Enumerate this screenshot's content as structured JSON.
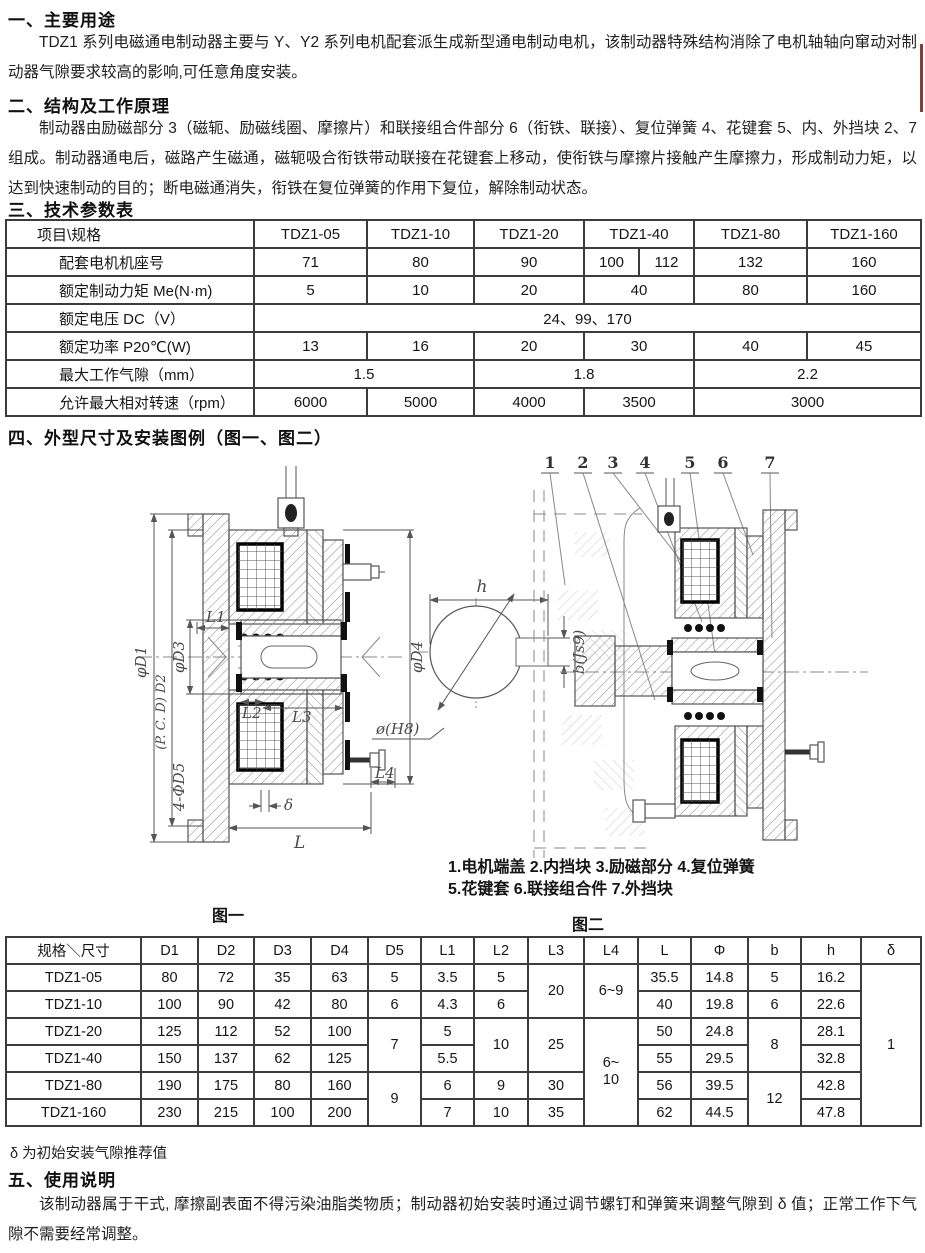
{
  "sections": {
    "s1": {
      "heading": "一、主要用途",
      "body": "TDZ1 系列电磁通电制动器主要与 Y、Y2 系列电机配套派生成新型通电制动电机，该制动器特殊结构消除了电机轴轴向窜动对制动器气隙要求较高的影响,可任意角度安装。"
    },
    "s2": {
      "heading": "二、结构及工作原理",
      "body": "制动器由励磁部分 3（磁轭、励磁线圈、摩擦片）和联接组合件部分 6（衔铁、联接）、复位弹簧 4、花键套 5、内、外挡块 2、7 组成。制动器通电后，磁路产生磁通，磁轭吸合衔铁带动联接在花键套上移动，使衔铁与摩擦片接触产生摩擦力，形成制动力矩，以达到快速制动的目的；断电磁通消失，衔铁在复位弹簧的作用下复位，解除制动状态。"
    },
    "s3": {
      "heading": "三、技术参数表"
    },
    "s4": {
      "heading": "四、外型尺寸及安装图例（图一、图二）"
    },
    "s5": {
      "heading": "五、使用说明",
      "body": "该制动器属于干式, 摩擦副表面不得污染油脂类物质；制动器初始安装时通过调节螺钉和弹簧来调整气隙到 δ 值；正常工作下气隙不需要经常调整。"
    }
  },
  "tech_table": {
    "header": [
      "项目\\规格",
      "TDZ1-05",
      "TDZ1-10",
      "TDZ1-20",
      "TDZ1-40",
      "TDZ1-80",
      "TDZ1-160"
    ],
    "motor_frame": {
      "label": "配套电机机座号",
      "v": [
        "71",
        "80",
        "90",
        "100",
        "112",
        "132",
        "160"
      ]
    },
    "torque": {
      "label": "额定制动力矩 Me(N·m)",
      "v": [
        "5",
        "10",
        "20",
        "40",
        "80",
        "160"
      ]
    },
    "voltage": {
      "label": "额定电压 DC（V）",
      "v": [
        "24、99、170"
      ]
    },
    "power": {
      "label": "额定功率 P20℃(W)",
      "v": [
        "13",
        "16",
        "20",
        "30",
        "40",
        "45"
      ]
    },
    "air_gap": {
      "label": "最大工作气隙（mm）",
      "v": [
        "1.5",
        "1.8",
        "2.2"
      ]
    },
    "max_speed": {
      "label": "允许最大相对转速（rpm）",
      "v": [
        "6000",
        "5000",
        "4000",
        "3500",
        "3000"
      ]
    }
  },
  "fig1": {
    "caption": "图一",
    "labels": {
      "d1": "φD1",
      "d2": "(P. C. D) D2",
      "d3": "φD3",
      "d4": "φD4",
      "d5": "4-ΦD5",
      "l1": "L1",
      "l2": "L2",
      "l3": "L3",
      "l4": "L4",
      "l": "L",
      "delta": "δ",
      "h": "h",
      "bore": "ø(H8)",
      "key": "b(Js9)"
    }
  },
  "fig2": {
    "caption": "图二",
    "part_numbers": [
      "1",
      "2",
      "3",
      "4",
      "5",
      "6",
      "7"
    ],
    "legend_line1": "1.电机端盖 2.内挡块 3.励磁部分 4.复位弹簧",
    "legend_line2": "5.花键套 6.联接组合件 7.外挡块"
  },
  "dim_table": {
    "header": [
      "规格＼尺寸",
      "D1",
      "D2",
      "D3",
      "D4",
      "D5",
      "L1",
      "L2",
      "L3",
      "L4",
      "L",
      "Φ",
      "b",
      "h",
      "δ"
    ],
    "r05": {
      "model": "TDZ1-05",
      "d1": "80",
      "d2": "72",
      "d3": "35",
      "d4": "63",
      "d5": "5",
      "l1": "3.5",
      "l2": "5",
      "l3": "20",
      "l4": "6~9",
      "l": "35.5",
      "phi": "14.8",
      "b": "5",
      "h": "16.2"
    },
    "r10": {
      "model": "TDZ1-10",
      "d1": "100",
      "d2": "90",
      "d3": "42",
      "d4": "80",
      "d5": "6",
      "l1": "4.3",
      "l2": "6",
      "l": "40",
      "phi": "19.8",
      "b": "6",
      "h": "22.6"
    },
    "r20": {
      "model": "TDZ1-20",
      "d1": "125",
      "d2": "112",
      "d3": "52",
      "d4": "100",
      "d5": "7",
      "l1": "5",
      "l2": "10",
      "l3": "25",
      "l4": "6~\n10",
      "l": "50",
      "phi": "24.8",
      "b": "8",
      "h": "28.1"
    },
    "r40": {
      "model": "TDZ1-40",
      "d1": "150",
      "d2": "137",
      "d3": "62",
      "d4": "125",
      "l1": "5.5",
      "l": "55",
      "phi": "29.5",
      "h": "32.8"
    },
    "r80": {
      "model": "TDZ1-80",
      "d1": "190",
      "d2": "175",
      "d3": "80",
      "d4": "160",
      "d5": "9",
      "l1": "6",
      "l2": "9",
      "l3": "30",
      "l": "56",
      "phi": "39.5",
      "b": "12",
      "h": "42.8"
    },
    "r160": {
      "model": "TDZ1-160",
      "d1": "230",
      "d2": "215",
      "d3": "100",
      "d4": "200",
      "l1": "7",
      "l2": "10",
      "l3": "35",
      "l": "62",
      "phi": "44.5",
      "h": "47.8"
    },
    "delta_all": "1"
  },
  "notes": {
    "delta_note": "δ 为初始安装气隙推荐值"
  },
  "colors": {
    "edge_mark": "#8a3c3c",
    "table_border": "#3c3c3c"
  }
}
